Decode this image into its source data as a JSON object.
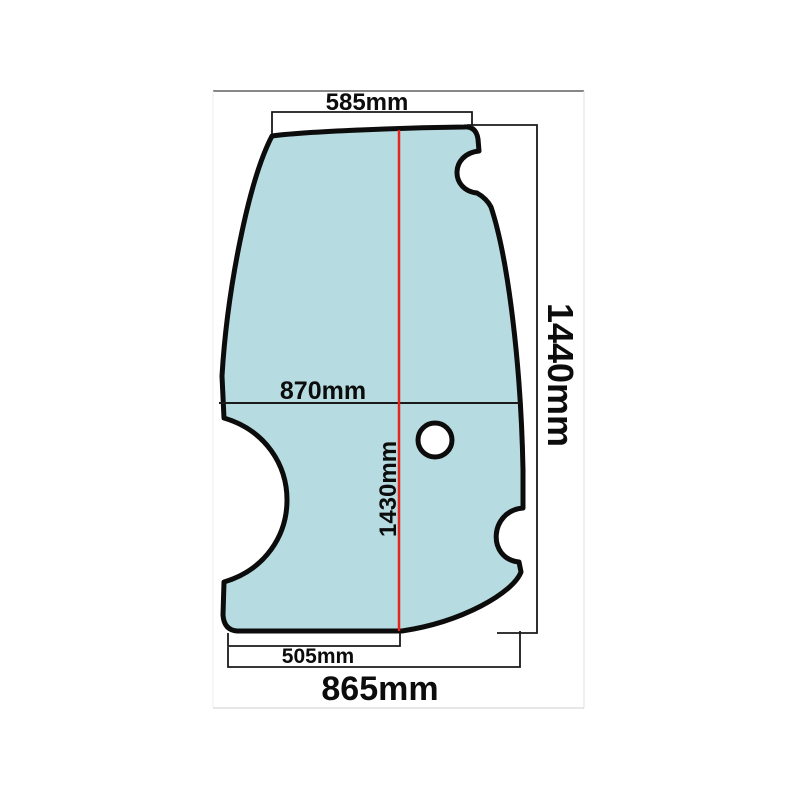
{
  "page": {
    "description": "Technical dimension diagram of a shaped cab door glass panel on a white product-photo background"
  },
  "diagram": {
    "labels": {
      "top_width": "585mm",
      "overall_height": "1440mm",
      "mid_width": "870mm",
      "center_height": "1430mm",
      "bottom_inner_width": "505mm",
      "overall_width": "865mm"
    },
    "colors": {
      "glass_fill": "#b6dce1",
      "glass_outline": "#0c0c0c",
      "dimension_line": "#1a1a1a",
      "red_accent": "#e8251c",
      "frame_top_border": "#606060",
      "frame_side_border": "#e2e2e2",
      "frame_bottom_border": "#cfcfcf"
    }
  }
}
